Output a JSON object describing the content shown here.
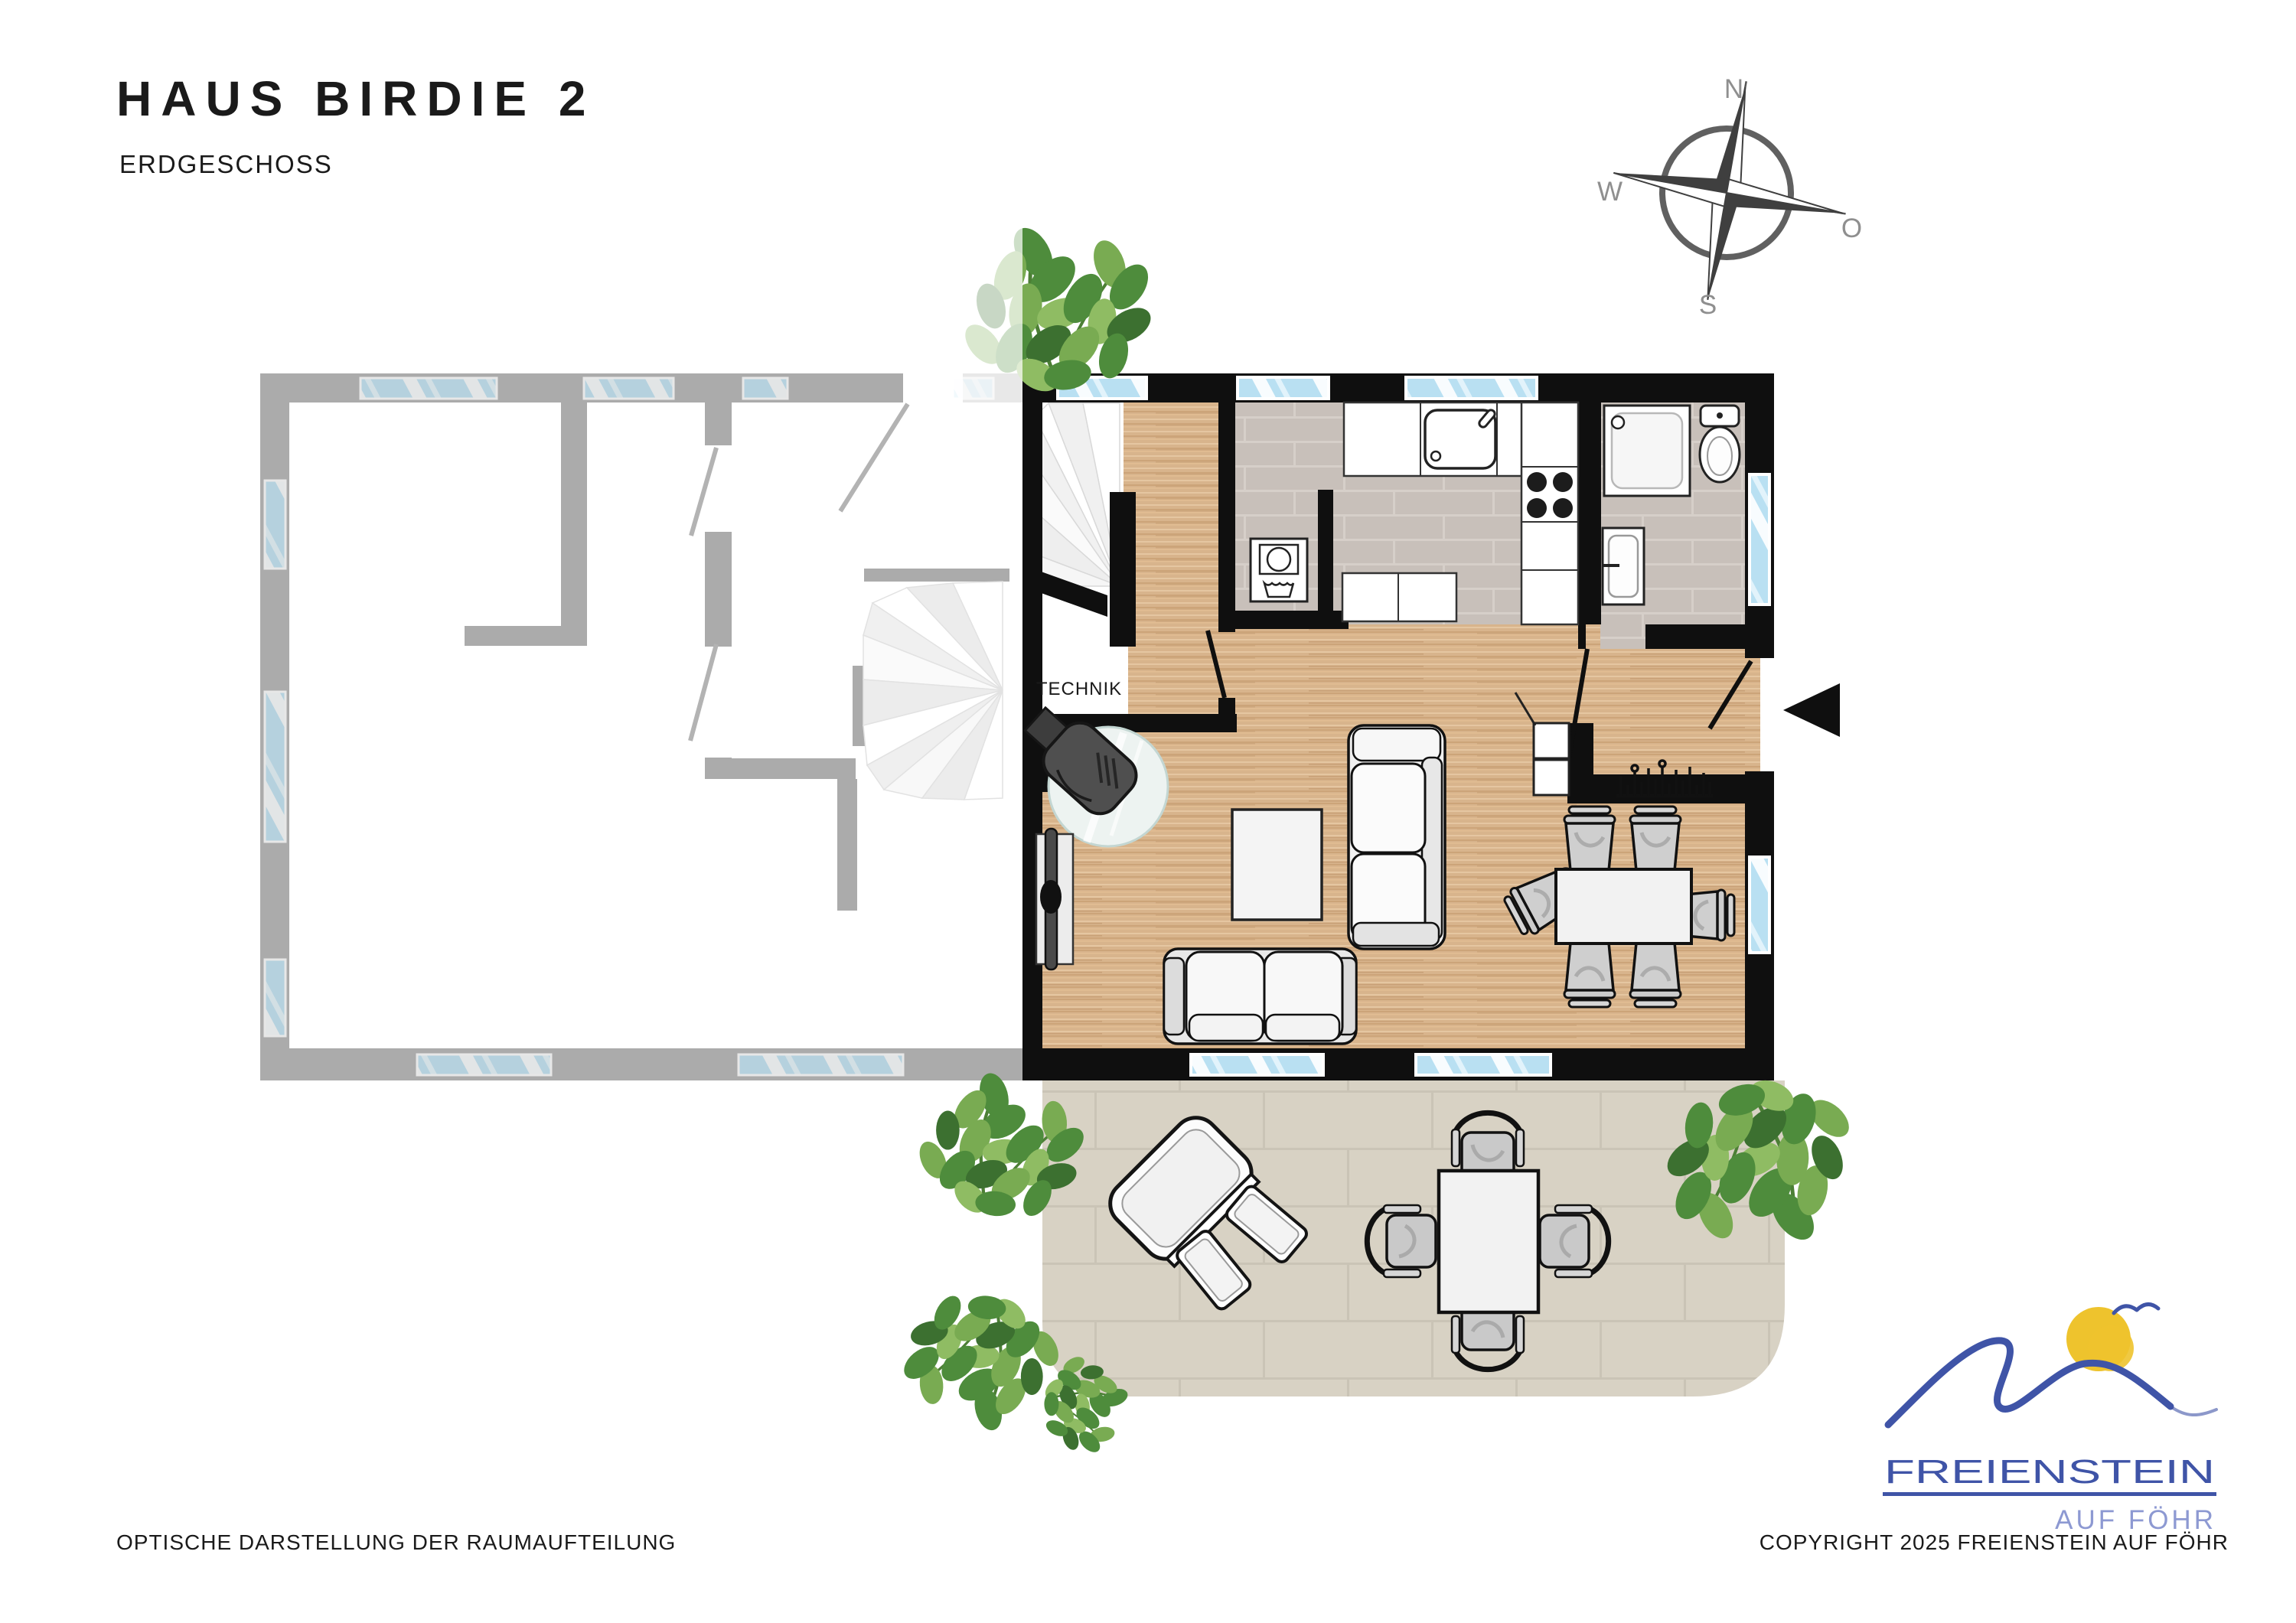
{
  "header": {
    "title": "HAUS BIRDIE 2",
    "subtitle": "ERDGESCHOSS"
  },
  "compass": {
    "north": "N",
    "east": "O",
    "south": "S",
    "west": "W"
  },
  "plan": {
    "technik_label": "TECHNIK"
  },
  "logo": {
    "brand": "FREIENSTEIN",
    "tagline": "AUF FÖHR"
  },
  "footer": {
    "disclaimer": "OPTISCHE DARSTELLUNG DER RAUMAUFTEILUNG",
    "copyright": "COPYRIGHT 2025 FREIENSTEIN AUF FÖHR"
  },
  "colors": {
    "wall_active": "#0f0f0f",
    "wall_neighbor": "#ababab",
    "floor_wood": "#d8b48c",
    "floor_tile": "#c8c0ba",
    "terrace": "#d8d2c4",
    "window_glass": "#b9e0f2",
    "plant_green": "#4e8c3c",
    "logo_blue": "#3f54a7",
    "logo_light_blue": "#8d99d2",
    "sun_yellow": "#eec32d",
    "compass_gray": "#8f8f8f"
  }
}
